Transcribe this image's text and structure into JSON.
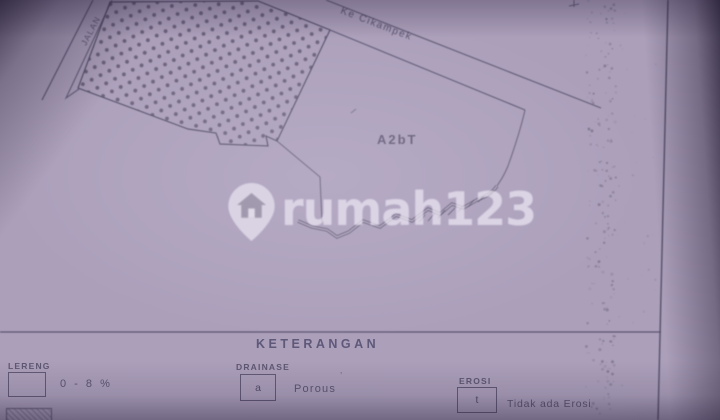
{
  "map": {
    "labels": {
      "left_road": "JALAN",
      "top_road": "Ke Cikampek",
      "parcel": "A2bT"
    }
  },
  "watermark": {
    "text": "rumah123",
    "icon": "house-pin-icon"
  },
  "legend": {
    "title": "KETERANGAN",
    "items": [
      {
        "label": "LERENG",
        "symbol": "",
        "value": "0 - 8 %"
      },
      {
        "label": "DRAINASE",
        "symbol": "a",
        "value": "Porous"
      },
      {
        "label": "EROSI",
        "symbol": "t",
        "value": "Tidak ada Erosi"
      }
    ]
  },
  "colors": {
    "paper": "#ab9fba",
    "ink": "#544e68",
    "stipple_dots": "#564e66",
    "watermark_text": "rgba(242,238,248,0.68)"
  }
}
